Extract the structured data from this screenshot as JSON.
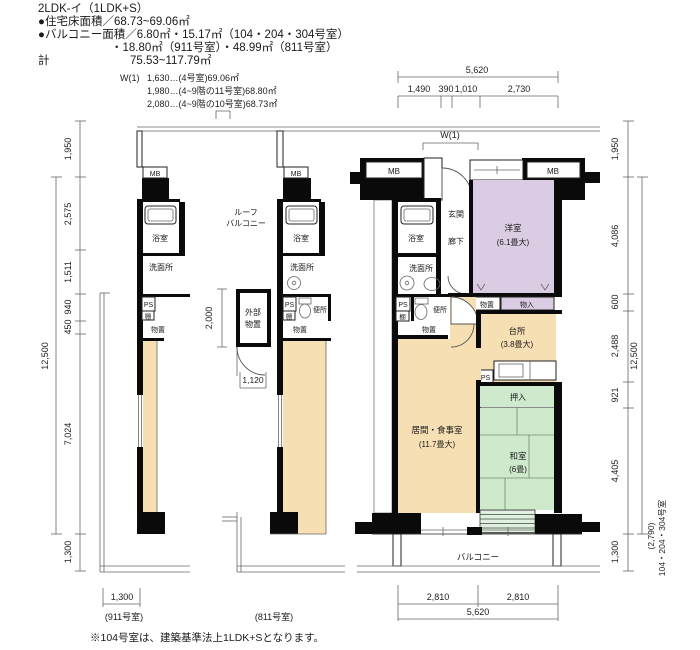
{
  "header": {
    "title": "2LDK-イ（1LDK+S）",
    "line_floor_area": "●住宅床面積／68.73~69.06㎡",
    "line_balcony_area": "●バルコニー面積／6.80㎡・15.17㎡（104・204・304号室）",
    "line_balcony_area2": "・18.80㎡（911号室）・48.99㎡（811号室）",
    "total_label": "計",
    "total_value": "75.53~117.79㎡"
  },
  "w1_note": {
    "label": "W(1)",
    "line1": "1,630…(4号室)69.06㎡",
    "line2": "1,980…(4~9階の11号室)68.80㎡",
    "line3": "2,080…(4~9階の10号室)68.73㎡"
  },
  "dims": {
    "top_total": "5,620",
    "top_segs": [
      "1,490",
      "390",
      "1,010",
      "2,730"
    ],
    "bottom_segs": [
      "2,810",
      "2,810"
    ],
    "bottom_total": "5,620",
    "left_segs": [
      "1,950",
      "2,575",
      "1,511",
      "940",
      "450",
      "7,024",
      "1,300"
    ],
    "left_total": "12,500",
    "right_segs": [
      "1,950",
      "4,086",
      "600",
      "2,488",
      "921",
      "4,405",
      "1,300"
    ],
    "right_total": "12,500",
    "right_extra_dim": "(2,790)",
    "right_extra_rooms": "104・204・304号室",
    "storage_height": "2,000",
    "storage_door": "1,120",
    "left_balcony_width": "1,300"
  },
  "plan_left": {
    "mb": "MB",
    "bath": "浴室",
    "wash": "洗面所",
    "ps": "PS",
    "shelf": "棚",
    "storage": "物置",
    "caption": "(911号室)"
  },
  "plan_mid": {
    "mb": "MB",
    "bath": "浴室",
    "wash": "洗面所",
    "ps": "PS",
    "shelf": "棚",
    "toilet": "便所",
    "storage": "物置",
    "ext_storage_1": "外部",
    "ext_storage_2": "物置",
    "roof_1": "ルーフ",
    "roof_2": "バルコニー",
    "caption": "(811号室)"
  },
  "plan_right": {
    "w1": "W(1)",
    "mb_left": "MB",
    "mb_right": "MB",
    "entrance": "玄関",
    "hall": "廊下",
    "bath": "浴室",
    "wash": "洗面所",
    "ps": "PS",
    "shelf": "棚",
    "toilet": "便所",
    "storage": "物置",
    "storage2": "物置",
    "closet": "物入",
    "western": "洋室",
    "western_size": "(6.1畳大)",
    "kitchen": "台所",
    "kitchen_size": "(3.8畳大)",
    "ps2": "PS",
    "oshiire": "押入",
    "living": "居間・食事室",
    "living_size": "(11.7畳大)",
    "washitsu": "和室",
    "washitsu_size": "(6畳)",
    "balcony": "バルコニー"
  },
  "footer": {
    "note": "※104号室は、建築基準法上1LDK+Sとなります。"
  },
  "colors": {
    "beige": "#f7dfb4",
    "purple": "#dacce2",
    "green": "#cfe9cd",
    "wall": "#0a0a0a"
  }
}
